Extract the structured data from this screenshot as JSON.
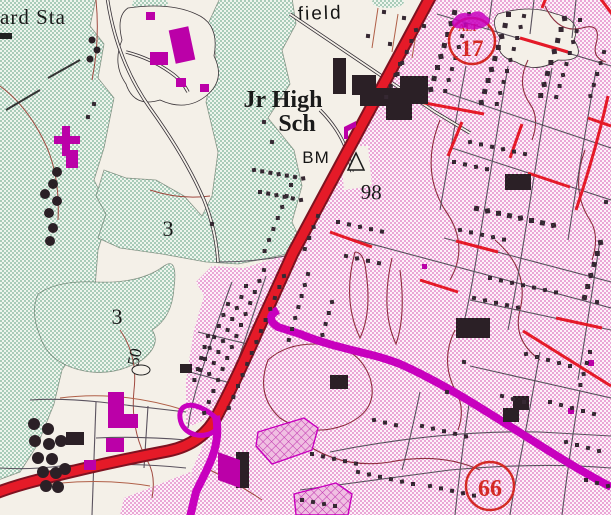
{
  "map": {
    "labels": {
      "guard_station_partial": "ard Sta",
      "field_partial": "field",
      "school_line1": "Jr High",
      "school_line2": "Sch",
      "benchmark": "BM",
      "benchmark_elevation": "98",
      "area_number_upper": "3",
      "area_number_lower": "3",
      "contour_elevation": "50"
    },
    "shields": {
      "alt17": {
        "banner": "ALT",
        "number": "17"
      },
      "route66": {
        "number": "66"
      }
    },
    "colors": {
      "background": "#f4f0e8",
      "woodland_green_tint": "#a9ccb9",
      "urban_pink_tint": "#eaa6d6",
      "road_red": "#e51a28",
      "road_red_casing": "#7e1220",
      "road_magenta": "#c800be",
      "building_black": "#2b2026",
      "building_magenta": "#bb00a8",
      "contour_brown": "#a0493f",
      "shield_red": "#d42a24"
    }
  }
}
